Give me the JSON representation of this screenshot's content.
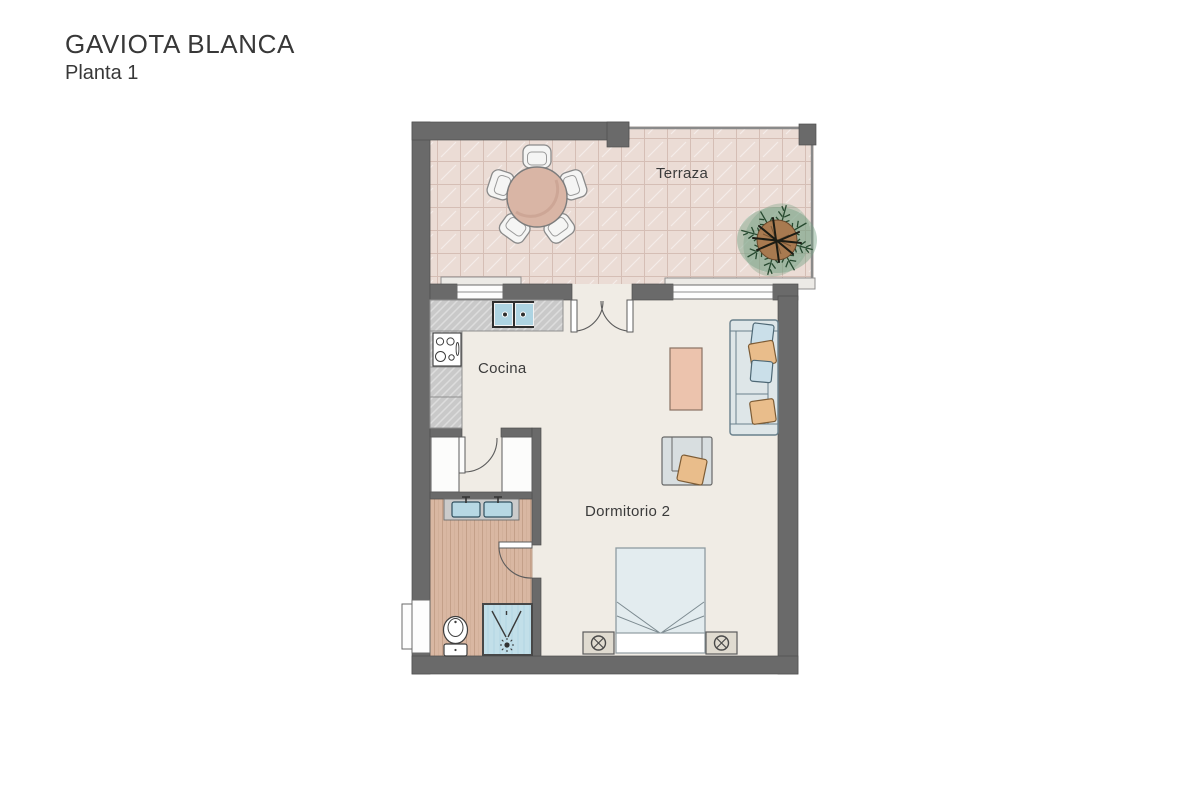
{
  "title": "GAVIOTA BLANCA",
  "subtitle": "Planta 1",
  "rooms": {
    "terrace": {
      "label": "Terraza"
    },
    "kitchen": {
      "label": "Cocina"
    },
    "bedroom": {
      "label": "Dormitorio 2"
    }
  },
  "colors": {
    "wall": "#6a6a6a",
    "terrace_floor": "#ebdcd5",
    "terrace_grid": "#d5beb5",
    "interior_floor": "#f0ece5",
    "bathroom_floor": "#d9b7a2",
    "counter_gray": "#c9c9c9",
    "water_blue": "#b7d8e4",
    "accent_pink": "#ecc3ad",
    "table_pink": "#d9b5a5",
    "sofa_gray": "#dee6e8",
    "pillow_blue": "#cadfe9",
    "pillow_orange": "#e9bd8b",
    "plant_green": "#26492f",
    "trunk_brown": "#a87a50"
  }
}
